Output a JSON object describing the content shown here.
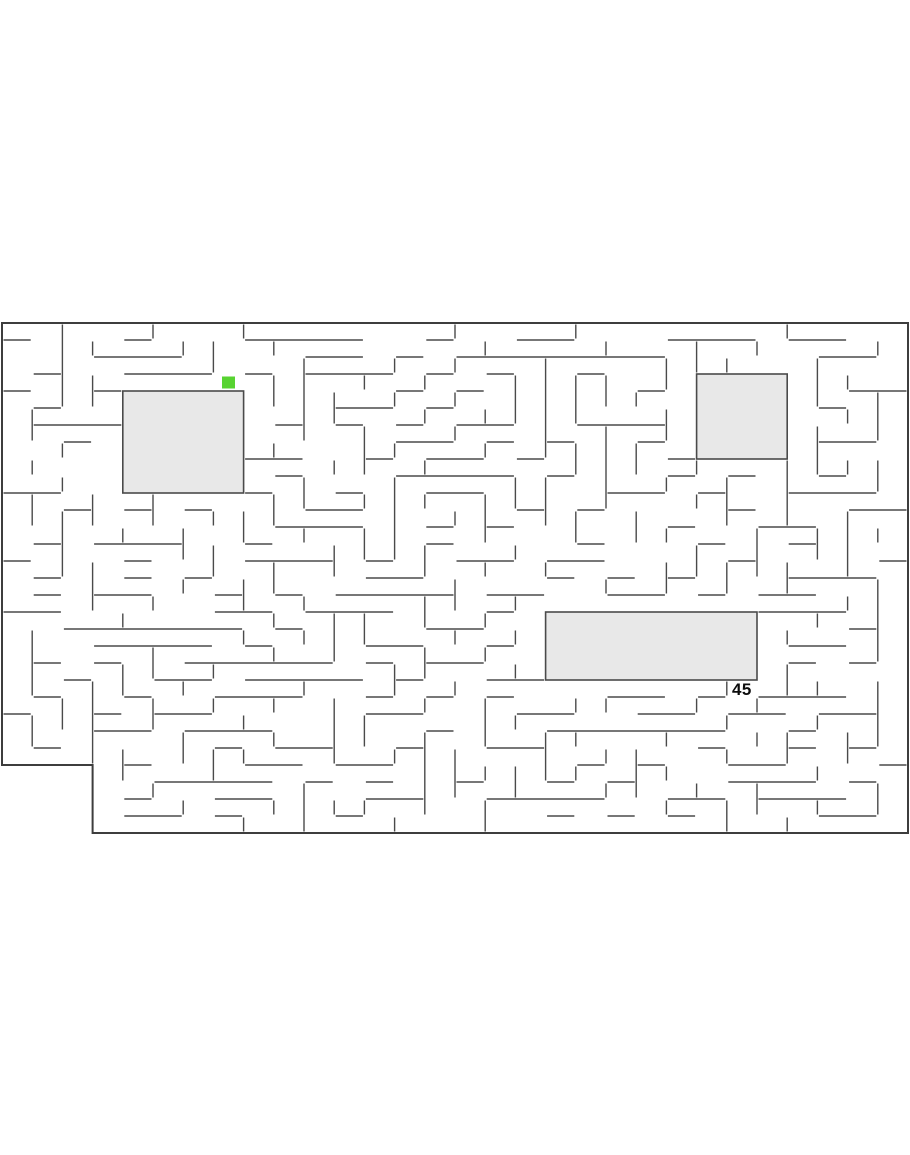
{
  "scene": {
    "background_color": "#ffffff",
    "width": 910,
    "height": 1155
  },
  "maze": {
    "origin_x": 2,
    "origin_y": 323,
    "cols": 30,
    "rows": 30,
    "cell_w": 30.2,
    "cell_h": 17,
    "wall_color": "#4a4a4a",
    "wall_width": 1.4,
    "border_color": "#3d3d3d",
    "border_width": 2,
    "wall_gap": 1.5,
    "seed": 73,
    "braid": 0.1,
    "outline": [
      [
        2,
        323
      ],
      [
        908,
        323
      ],
      [
        908,
        833
      ],
      [
        92.6,
        833
      ],
      [
        92.6,
        765
      ],
      [
        2,
        765
      ]
    ],
    "excluded": [
      {
        "c1": 0,
        "c2": 2,
        "r1": 26,
        "r2": 29
      }
    ],
    "rooms": [
      {
        "c1": 4,
        "c2": 7,
        "r1": 4,
        "r2": 9,
        "fill": "#e8e8e8"
      },
      {
        "c1": 23,
        "c2": 25,
        "r1": 3,
        "r2": 7,
        "fill": "#e8e8e8"
      },
      {
        "c1": 18,
        "c2": 24,
        "r1": 17,
        "r2": 20,
        "fill": "#e8e8e8"
      }
    ],
    "player": {
      "col": 7,
      "row": 3,
      "color": "#57d331",
      "width": 13,
      "height": 12
    },
    "label": {
      "text": "45",
      "col": 24,
      "row": 21,
      "color": "#0d0d0d",
      "font_size": 17
    }
  }
}
